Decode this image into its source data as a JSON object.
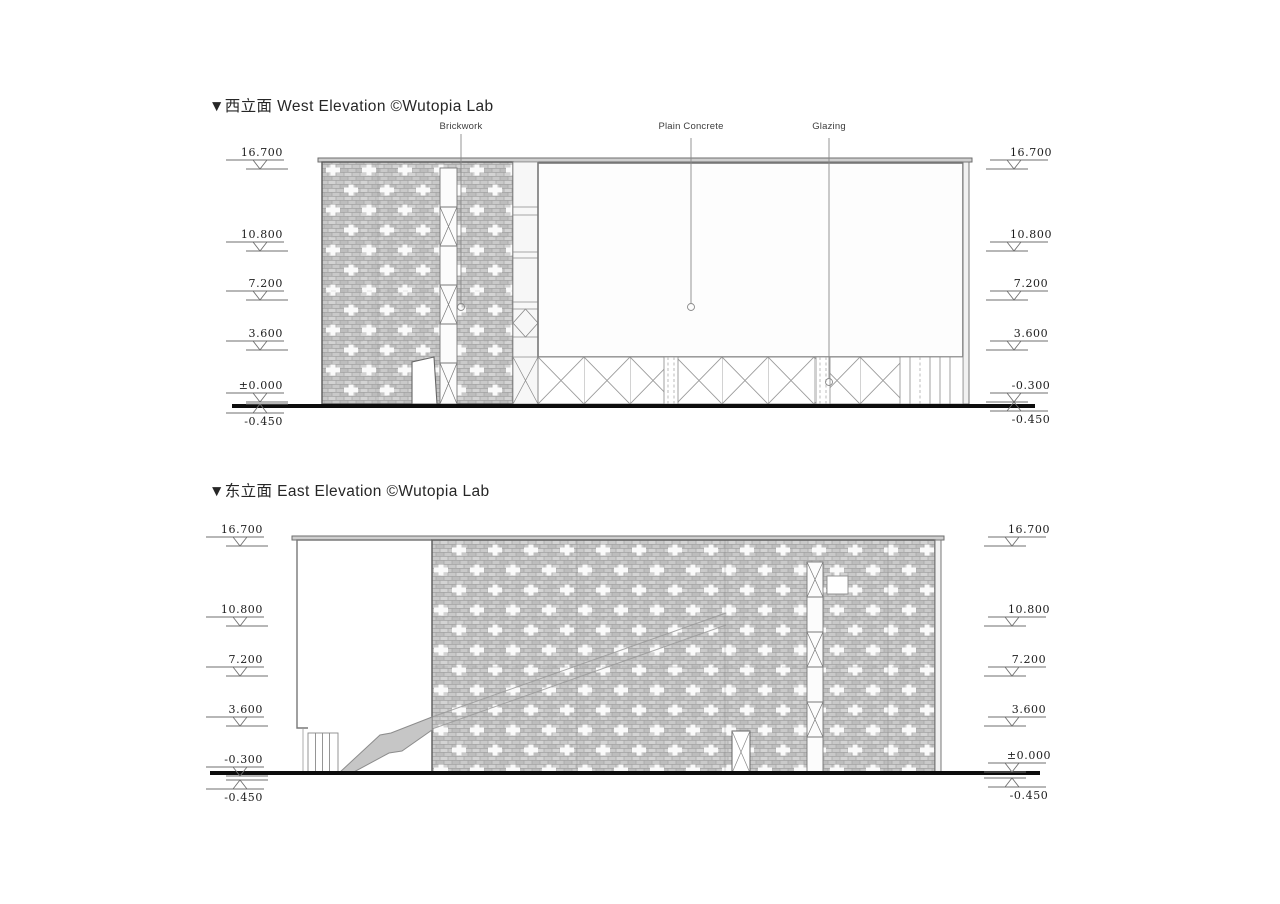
{
  "colors": {
    "brick": "#c9c9c9",
    "brick_joint": "#a3a3a3",
    "cross": "#fafafa",
    "outline": "#5a5a5a",
    "detail": "#8a8a8a",
    "ground": "#0d0d0d",
    "stair_fill": "#c6c6c6"
  },
  "west": {
    "title": "▼西立面 West Elevation ©Wutopia Lab",
    "materials": [
      "Brickwork",
      "Plain Concrete",
      "Glazing"
    ],
    "levels_left": [
      "16.700",
      "10.800",
      "7.200",
      "3.600",
      "±0.000",
      "-0.450"
    ],
    "levels_right": [
      "16.700",
      "10.800",
      "7.200",
      "3.600",
      "-0.300",
      "-0.450"
    ]
  },
  "east": {
    "title": "▼东立面 East Elevation ©Wutopia Lab",
    "levels_left": [
      "16.700",
      "10.800",
      "7.200",
      "3.600",
      "-0.300",
      "-0.450"
    ],
    "levels_right": [
      "16.700",
      "10.800",
      "7.200",
      "3.600",
      "±0.000",
      "-0.450"
    ]
  }
}
